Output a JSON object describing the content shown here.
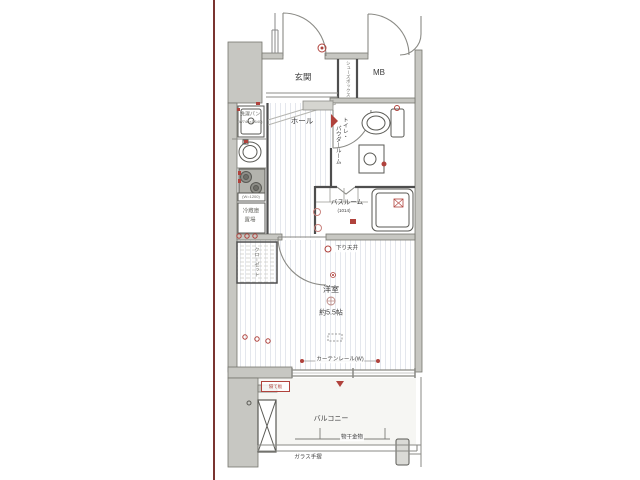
{
  "page": {
    "background": "#ffffff",
    "left_accent_line_color": "#7a3430"
  },
  "colors": {
    "wall_fill": "#c7c7c2",
    "wall_edge": "#76766f",
    "interior_wall": "#4e4e4e",
    "floor_stripe": "#e4e7ed",
    "balcony_floor": "#f6f6f3",
    "annotation_red": "#b0423c"
  },
  "rooms": {
    "genkan": {
      "label": "玄関"
    },
    "shoes_box": {
      "label": "シューズボックス"
    },
    "meter_box": {
      "label": "MB"
    },
    "hall": {
      "label": "ホール"
    },
    "toilet_powder": {
      "line1": "トイレ・",
      "line2": "パウダールーム"
    },
    "bathroom": {
      "label": "バスルーム",
      "size": "(1014)"
    },
    "western_room": {
      "label": "洋室",
      "size": "約5.5帖"
    },
    "closet": {
      "label": "クローゼット"
    },
    "balcony": {
      "label": "バルコニー"
    }
  },
  "fixtures": {
    "laundry_pan": {
      "label": "洗濯パン",
      "size": "(W740×D640)"
    },
    "kitchen_counter": {
      "label": "(W=1200)"
    },
    "fridge": {
      "line1": "冷蔵庫",
      "line2": "置場"
    },
    "lowered_ceiling": {
      "label": "下り天井"
    },
    "curtain_rail": {
      "label": "カーテンレール(W)"
    },
    "drying_hardware": {
      "label": "物干金物"
    },
    "glass_handrail": {
      "label": "ガラス手摺"
    },
    "partition": {
      "label": "隔て板"
    }
  }
}
